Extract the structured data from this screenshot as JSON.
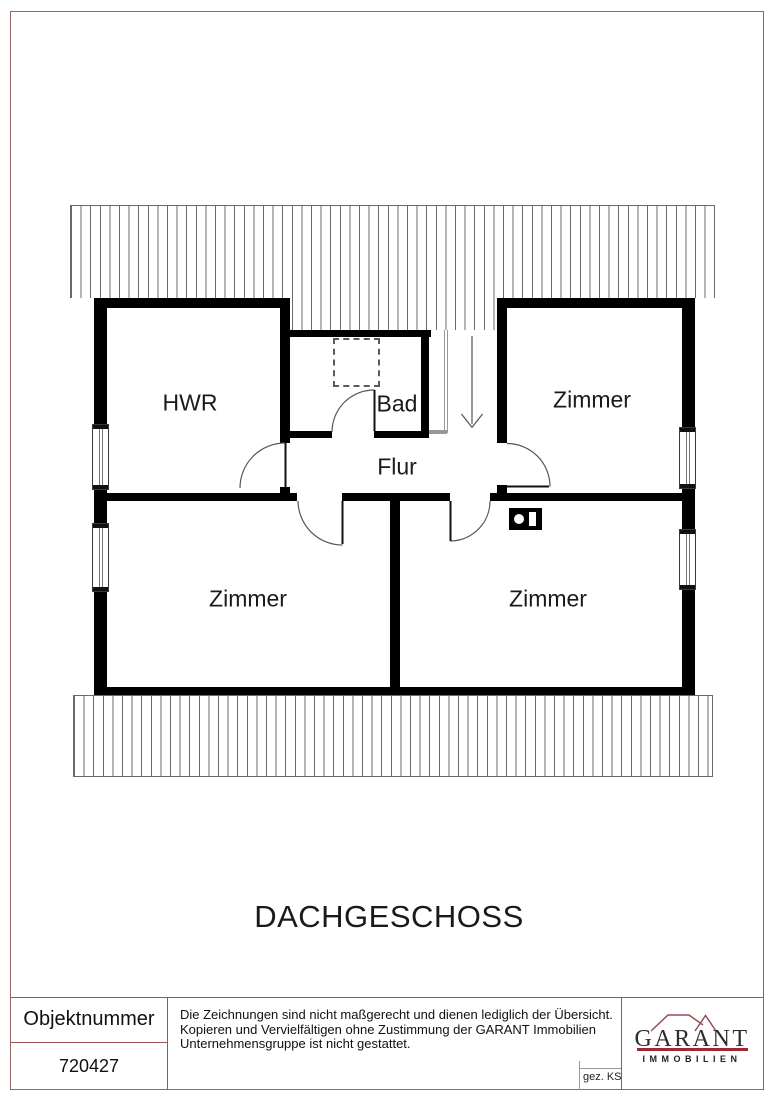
{
  "colors": {
    "frame-red": "#9a6363",
    "panel-red": "#a35252",
    "logo-red": "#9e2a33",
    "logo-roof-red": "#9a4d55",
    "logo-text": "#2c2c34",
    "wall-black": "#000000",
    "hatch-gray": "#6a6a6a",
    "door-gray": "#555555"
  },
  "plan": {
    "labels": {
      "hwr": "HWR",
      "bad": "Bad",
      "zimmer_top_right": "Zimmer",
      "flur": "Flur",
      "zimmer_bottom_left": "Zimmer",
      "zimmer_bottom_right": "Zimmer"
    }
  },
  "title": "DACHGESCHOSS",
  "footer": {
    "object_number_label": "Objektnummer",
    "object_number_value": "720427",
    "disclaimer": {
      "line1": "Die Zeichnungen sind nicht maßgerecht und dienen lediglich der Übersicht.",
      "line2": "Kopieren und Vervielfältigen ohne Zustimmung der GARANT Immobilien",
      "line3": "Unternehmensgruppe ist nicht gestattet."
    },
    "drawn_by": "gez. KS",
    "logo": {
      "brand": "GARANT",
      "subtitle": "IMMOBILIEN"
    }
  }
}
